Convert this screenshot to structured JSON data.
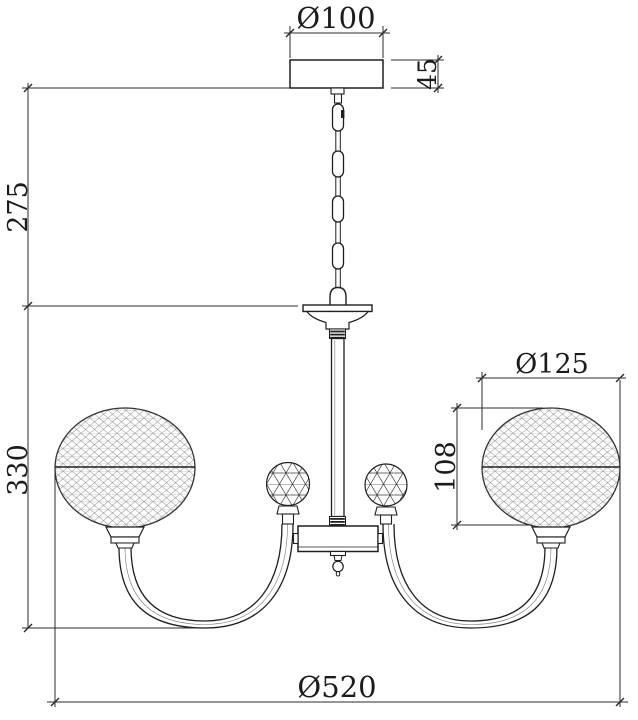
{
  "drawing": {
    "type": "technical-dimension-drawing",
    "subject": "4-arm chandelier with mesh crystal globes, front elevation",
    "units_note": "mm (implied)",
    "colors": {
      "background": "#ffffff",
      "object_line": "#1f1f1f",
      "dimension_line": "#2b2b2b",
      "mesh_pattern": "#9a9a9a",
      "facet_pattern": "#3c3c3c"
    },
    "dims": {
      "canopy_diameter": "Ø100",
      "canopy_height": "45",
      "chain_drop": "275",
      "body_drop": "330",
      "globe_diameter": "Ø125",
      "globe_height": "108",
      "overall_width": "Ø520"
    }
  }
}
